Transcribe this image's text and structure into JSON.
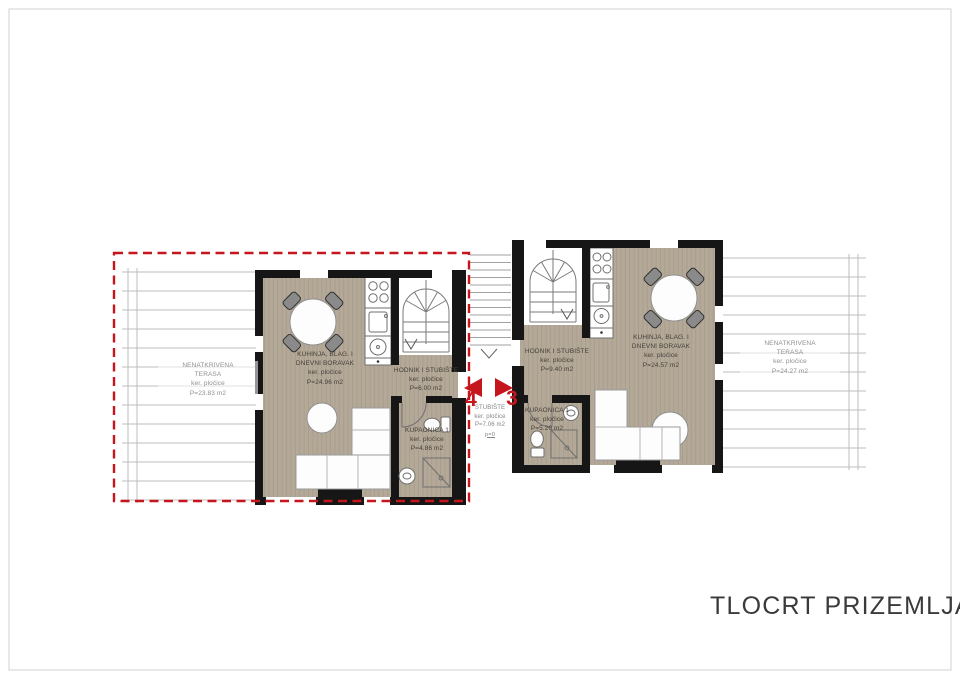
{
  "title": "TLOCRT PRIZEMLJA",
  "colors": {
    "floor_tan": "#b4a998",
    "floor_stripe": "#a69b89",
    "wall_black": "#161616",
    "accent_red": "#c5161d",
    "terrace_line": "#bdbdbd",
    "terrace_label": "#8f8f8f",
    "room_label": "#45403a",
    "title_color": "#3a3a3a"
  },
  "markers": {
    "left": "4",
    "right": "3"
  },
  "terraces": {
    "left": {
      "line1": "NENATKRIVENA",
      "line2": "TERASA",
      "line3": "ker. pločice",
      "line4": "P=23.83 m2"
    },
    "right": {
      "line1": "NENATKRIVENA",
      "line2": "TERASA",
      "line3": "ker. pločice",
      "line4": "P=24.27 m2"
    }
  },
  "unit_left": {
    "living": {
      "line1": "KUHINJA, BLAG. I",
      "line2": "DNEVNI BORAVAK",
      "line3": "ker. pločice",
      "line4": "P=24.96 m2"
    },
    "hall": {
      "line1": "HODNIK I STUBIŠTE",
      "line2": "ker. pločice",
      "line3": "P=6.00 m2"
    },
    "bath": {
      "line1": "KUPAONICA 1",
      "line2": "ker. pločice",
      "line3": "P=4.86 m2"
    }
  },
  "unit_right": {
    "hall": {
      "line1": "HODNIK I STUBIŠTE",
      "line2": "ker. pločice",
      "line3": "P=9.40 m2"
    },
    "living": {
      "line1": "KUHINJA, BLAG. I",
      "line2": "DNEVNI BORAVAK",
      "line3": "ker. pločice",
      "line4": "P=24.57 m2"
    },
    "bath": {
      "line1": "KUPAONICA 1",
      "line2": "ker. pločice",
      "line3": "P=5.26 m2"
    }
  },
  "stairwell": {
    "line1": "STUBIŠTE",
    "line2": "ker. pločice",
    "line3": "P=7.06 m2",
    "line4": "p=0"
  }
}
